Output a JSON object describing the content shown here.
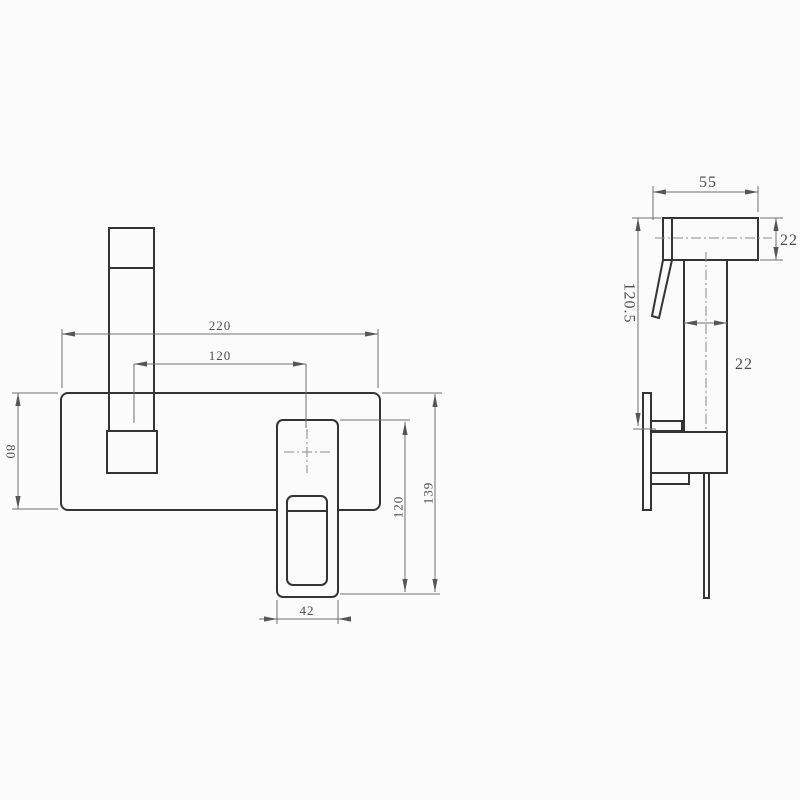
{
  "drawing": {
    "title": "wall-mounted basin mixer technical drawing",
    "colors": {
      "background": "#fbfbfb",
      "object_line": "#343434",
      "dimension_line": "#6f6f6f"
    },
    "front_view": {
      "dims": {
        "plate_width": "220",
        "spout_to_handle_center": "120",
        "plate_height": "80",
        "handle_width": "42",
        "handle_length": "120",
        "overall_height": "139"
      }
    },
    "side_view": {
      "dims": {
        "handle_depth": "55",
        "handle_thickness": "22",
        "overall_drop": "120.5",
        "body_width": "22"
      }
    }
  }
}
